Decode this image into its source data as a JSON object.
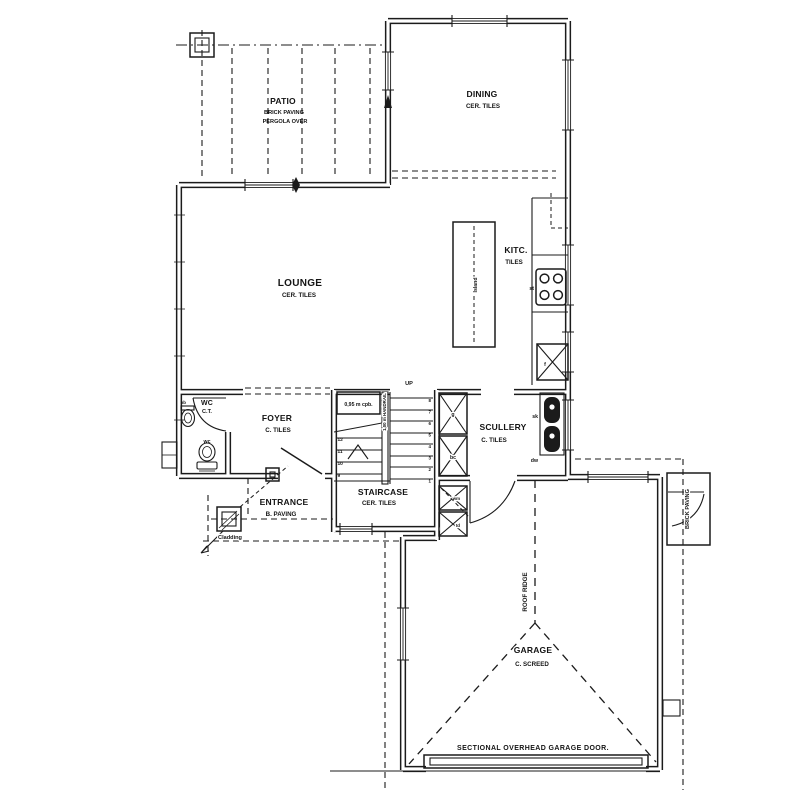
{
  "drawing": {
    "rooms": {
      "patio": {
        "name": "PATIO",
        "line2": "BRICK PAVING",
        "line3": "PERGOLA OVER"
      },
      "dining": {
        "name": "DINING",
        "finish": "CER. TILES"
      },
      "kitchen": {
        "name": "KITC.",
        "finish": "TILES"
      },
      "lounge": {
        "name": "LOUNGE",
        "finish": "CER. TILES"
      },
      "wc": {
        "name": "WC",
        "finish": "C.T."
      },
      "foyer": {
        "name": "FOYER",
        "finish": "C. TILES"
      },
      "staircase": {
        "name": "STAIRCASE",
        "finish": "CER. TILES"
      },
      "scullery": {
        "name": "SCULLERY",
        "finish": "C. TILES"
      },
      "entrance": {
        "name": "ENTRANCE",
        "finish": "B. PAVING"
      },
      "garage": {
        "name": "GARAGE",
        "finish": "C. SCREED"
      }
    },
    "annotations": {
      "up": "UP",
      "cupboard": "0,95 m cpb.",
      "handrail": "1,00 m HANDRAIL",
      "island": "Island",
      "roof_ridge": "ROOF RIDGE",
      "garage_door": "SECTIONAL OVERHEAD GARAGE DOOR.",
      "brick_paving_side": "BRICK PAVING",
      "cladding": "Cladding",
      "stair_numbers_left": [
        "12",
        "11",
        "10",
        "9"
      ],
      "stair_numbers_right": [
        "8",
        "7",
        "6",
        "5",
        "4",
        "3",
        "2",
        "1"
      ]
    },
    "fixtures": {
      "stove": "st",
      "fridge": "f",
      "sink": "sk",
      "dishwasher": "dw",
      "geyser": "g",
      "broom_cupboard": "bc",
      "washing_machine": "wm",
      "tumble_dryer": "td",
      "toilet": "wc",
      "hand_basin": "hb"
    },
    "colors": {
      "line": "#1b1b1b",
      "background": "#ffffff"
    }
  }
}
